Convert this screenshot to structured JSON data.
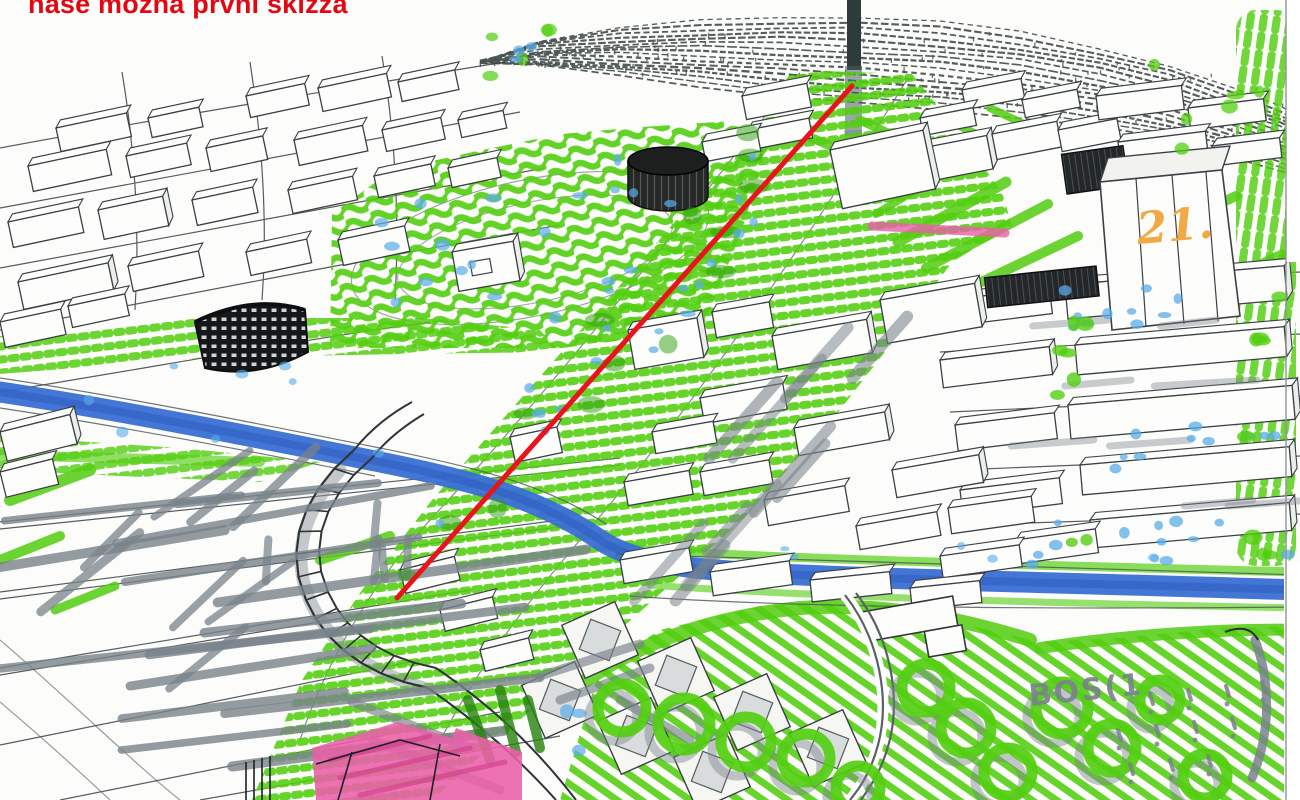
{
  "annotations": {
    "title": "naše možná první skizza",
    "building_label": "21.",
    "park_note": "BOS(1"
  },
  "palette": {
    "title_red": "#e30613",
    "axis_red": "#e8141c",
    "marker_green": "#53ce10",
    "marker_green_dark": "#2f9e0d",
    "river_blue": "#3a6fd4",
    "river_blue_dark": "#2c57be",
    "tree_cyan": "#5aace8",
    "highlight_magenta": "#ea5fa8",
    "label_orange": "#f0a945",
    "shadow_gray": "#79838b",
    "ink": "#3a4045",
    "dark_building": "#1b1f21",
    "hill_stroke": "#4a5452",
    "paper": "#fcfcfa"
  }
}
